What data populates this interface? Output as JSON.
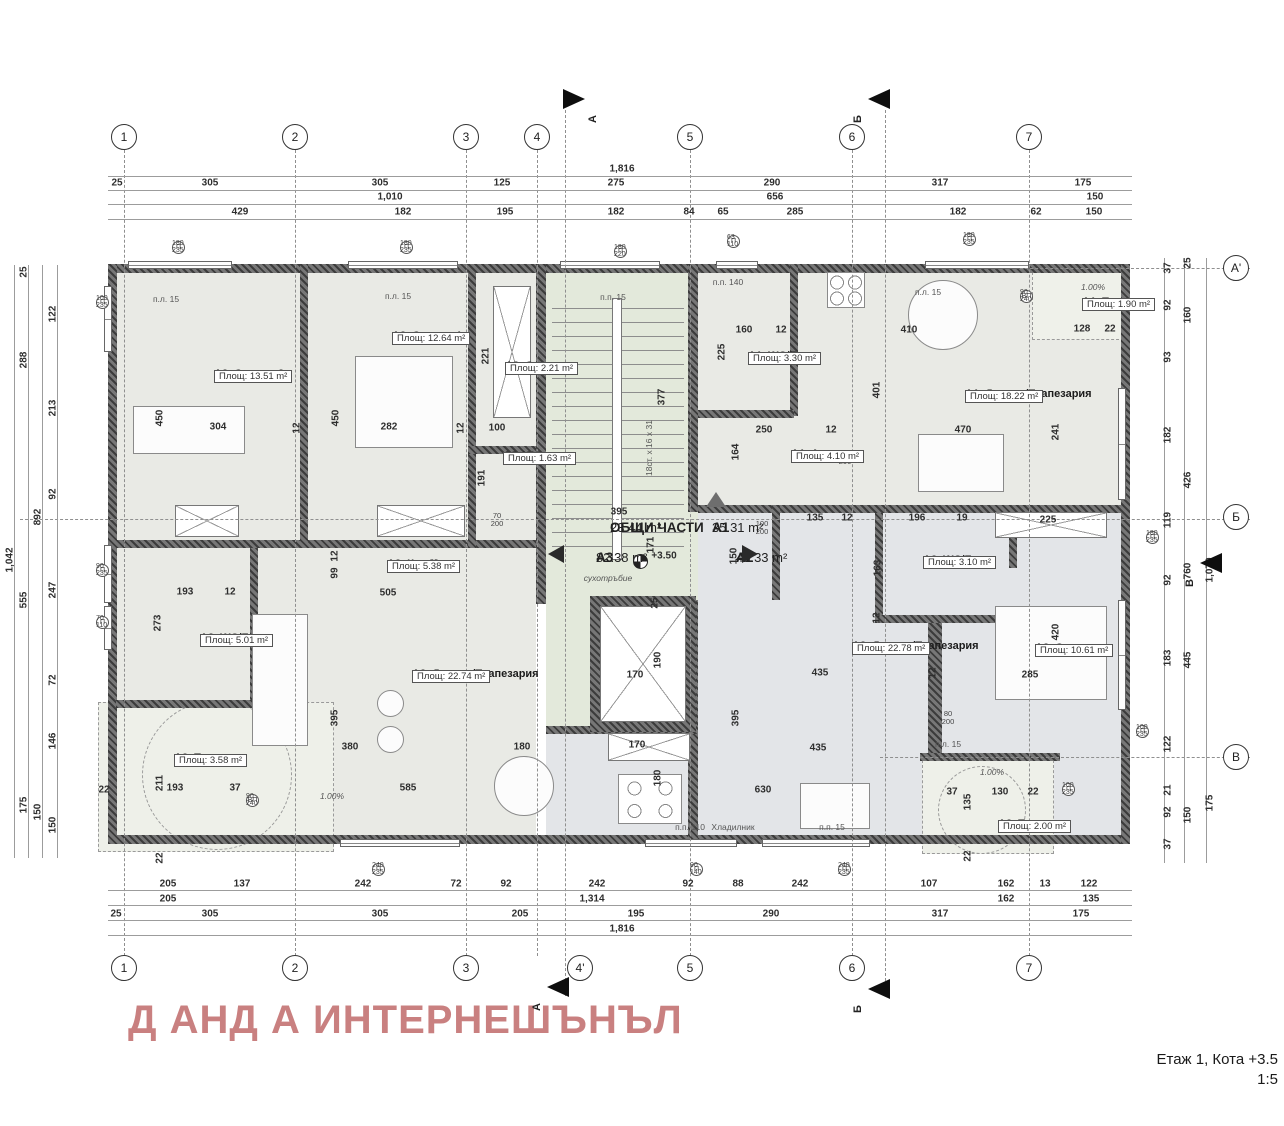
{
  "meta": {
    "watermark": "Д АНД А ИНТЕРНЕШЪНЪЛ",
    "title_line1": "Етаж 1, Кота +3.5",
    "title_line2": "1:5"
  },
  "colors": {
    "watermark": "#c98080",
    "wall": "#4a4a4a",
    "room_fill": "#e9eae5",
    "common_fill": "#e3e9db",
    "a2_fill": "#e3e5e8",
    "terrace_fill": "#eef0e9"
  },
  "grid": {
    "top": [
      {
        "t": "1",
        "x": 124
      },
      {
        "t": "2",
        "x": 295
      },
      {
        "t": "3",
        "x": 466
      },
      {
        "t": "4",
        "x": 537
      },
      {
        "t": "5",
        "x": 690
      },
      {
        "t": "6",
        "x": 852
      },
      {
        "t": "7",
        "x": 1029
      }
    ],
    "bottom": [
      {
        "t": "1",
        "x": 124
      },
      {
        "t": "2",
        "x": 295
      },
      {
        "t": "3",
        "x": 466
      },
      {
        "t": "4'",
        "x": 580
      },
      {
        "t": "5",
        "x": 690
      },
      {
        "t": "6",
        "x": 852
      },
      {
        "t": "7",
        "x": 1029
      }
    ],
    "right": [
      {
        "t": "A'",
        "y": 268
      },
      {
        "t": "Б",
        "y": 517
      },
      {
        "t": "В",
        "y": 757
      }
    ],
    "flags": [
      {
        "t": "А",
        "x": 563,
        "y": 99,
        "d": "right"
      },
      {
        "t": "Б",
        "x": 868,
        "y": 99,
        "d": "left"
      },
      {
        "t": "А",
        "x": 547,
        "y": 987,
        "d": "left"
      },
      {
        "t": "Б",
        "x": 868,
        "y": 989,
        "d": "left"
      },
      {
        "t": "В",
        "x": 1200,
        "y": 563,
        "d": "left"
      }
    ]
  },
  "rooms": [
    {
      "n": "A3_Спалня 2",
      "a": "Площ: 13.51 m²",
      "x": 214,
      "y": 368
    },
    {
      "n": "A3_Спалня 1",
      "a": "Площ: 12.64 m²",
      "x": 392,
      "y": 330
    },
    {
      "n": "A3_Склад",
      "a": "Площ: 2.21 m²",
      "x": 505,
      "y": 360
    },
    {
      "n": "A3_WC",
      "a": "Площ: 1.63 m²",
      "x": 503,
      "y": 450
    },
    {
      "n": "A1_WC/Баня",
      "a": "Площ: 3.30 m²",
      "x": 748,
      "y": 350
    },
    {
      "n": "A1_Антре",
      "a": "Площ: 4.10 m²",
      "x": 791,
      "y": 448
    },
    {
      "n": "A1_Дневна/Трапезария",
      "a": "Площ: 18.22 m²",
      "x": 965,
      "y": 388
    },
    {
      "n": "A1_Тераса",
      "a": "Площ: 1.90 m²",
      "x": 1082,
      "y": 296
    },
    {
      "n": "A3_Коридор",
      "a": "Площ: 5.38 m²",
      "x": 387,
      "y": 558
    },
    {
      "n": "A3_WC/Баня",
      "a": "Площ: 5.01 m²",
      "x": 200,
      "y": 632
    },
    {
      "n": "A3_Дневна/Трапезария",
      "a": "Площ: 22.74 m²",
      "x": 412,
      "y": 668
    },
    {
      "n": "A3_Тераса",
      "a": "Площ: 3.58 m²",
      "x": 174,
      "y": 752
    },
    {
      "n": "A2_WC/Баня",
      "a": "Площ: 3.10 m²",
      "x": 923,
      "y": 554
    },
    {
      "n": "A2_Дневна/Трапезария",
      "a": "Площ: 22.78 m²",
      "x": 852,
      "y": 640
    },
    {
      "n": "A2_Спалня",
      "a": "Площ: 10.61 m²",
      "x": 1035,
      "y": 642
    },
    {
      "n": "A2_Тераса",
      "a": "Площ: 2.00 m²",
      "x": 998,
      "y": 818
    }
  ],
  "summary": [
    {
      "c": "ОБЩИ ЧАСТИ",
      "a": "23.44 m²",
      "x": 610,
      "y": 520
    },
    {
      "c": "А3",
      "a": "82.38 m²",
      "x": 596,
      "y": 550,
      "arrow": "left",
      "ax": 556,
      "ay": 553
    },
    {
      "c": "A1",
      "a": "35.31 m²",
      "x": 712,
      "y": 520,
      "arrow": "up",
      "ax": 714,
      "ay": 500
    },
    {
      "c": "A2",
      "a": "48.33 m²",
      "x": 736,
      "y": 550,
      "arrow": "right",
      "ax": 750,
      "ay": 553
    }
  ],
  "level_mark": {
    "t": "+3.50",
    "x": 664,
    "y": 556
  },
  "dims": {
    "top": [
      {
        "t": "1,816",
        "x": 622,
        "y": 169
      },
      {
        "t": "25",
        "x": 117,
        "y": 183
      },
      {
        "t": "305",
        "x": 210,
        "y": 183
      },
      {
        "t": "305",
        "x": 380,
        "y": 183
      },
      {
        "t": "125",
        "x": 502,
        "y": 183
      },
      {
        "t": "275",
        "x": 616,
        "y": 183
      },
      {
        "t": "290",
        "x": 772,
        "y": 183
      },
      {
        "t": "317",
        "x": 940,
        "y": 183
      },
      {
        "t": "175",
        "x": 1083,
        "y": 183
      },
      {
        "t": "1,010",
        "x": 390,
        "y": 197
      },
      {
        "t": "656",
        "x": 775,
        "y": 197
      },
      {
        "t": "150",
        "x": 1095,
        "y": 197
      },
      {
        "t": "429",
        "x": 240,
        "y": 212
      },
      {
        "t": "182",
        "x": 403,
        "y": 212
      },
      {
        "t": "195",
        "x": 505,
        "y": 212
      },
      {
        "t": "182",
        "x": 616,
        "y": 212
      },
      {
        "t": "84",
        "x": 689,
        "y": 212
      },
      {
        "t": "65",
        "x": 723,
        "y": 212
      },
      {
        "t": "285",
        "x": 795,
        "y": 212
      },
      {
        "t": "182",
        "x": 958,
        "y": 212
      },
      {
        "t": "62",
        "x": 1036,
        "y": 212
      },
      {
        "t": "150",
        "x": 1094,
        "y": 212
      }
    ],
    "bottom": [
      {
        "t": "205",
        "x": 168,
        "y": 884
      },
      {
        "t": "137",
        "x": 242,
        "y": 884
      },
      {
        "t": "242",
        "x": 363,
        "y": 884
      },
      {
        "t": "72",
        "x": 456,
        "y": 884
      },
      {
        "t": "92",
        "x": 506,
        "y": 884
      },
      {
        "t": "242",
        "x": 597,
        "y": 884
      },
      {
        "t": "92",
        "x": 688,
        "y": 884
      },
      {
        "t": "88",
        "x": 738,
        "y": 884
      },
      {
        "t": "242",
        "x": 800,
        "y": 884
      },
      {
        "t": "107",
        "x": 929,
        "y": 884
      },
      {
        "t": "162",
        "x": 1006,
        "y": 884
      },
      {
        "t": "13",
        "x": 1045,
        "y": 884
      },
      {
        "t": "122",
        "x": 1089,
        "y": 884
      },
      {
        "t": "205",
        "x": 168,
        "y": 899
      },
      {
        "t": "1,314",
        "x": 592,
        "y": 899
      },
      {
        "t": "162",
        "x": 1006,
        "y": 899
      },
      {
        "t": "135",
        "x": 1091,
        "y": 899
      },
      {
        "t": "25",
        "x": 116,
        "y": 914
      },
      {
        "t": "305",
        "x": 210,
        "y": 914
      },
      {
        "t": "305",
        "x": 380,
        "y": 914
      },
      {
        "t": "205",
        "x": 520,
        "y": 914
      },
      {
        "t": "195",
        "x": 636,
        "y": 914
      },
      {
        "t": "290",
        "x": 771,
        "y": 914
      },
      {
        "t": "317",
        "x": 940,
        "y": 914
      },
      {
        "t": "175",
        "x": 1081,
        "y": 914
      },
      {
        "t": "1,816",
        "x": 622,
        "y": 929
      }
    ],
    "left": [
      {
        "t": "1,042",
        "x": 10,
        "y": 560,
        "r": -90
      },
      {
        "t": "25",
        "x": 24,
        "y": 272,
        "r": -90
      },
      {
        "t": "288",
        "x": 24,
        "y": 360,
        "r": -90
      },
      {
        "t": "555",
        "x": 24,
        "y": 600,
        "r": -90
      },
      {
        "t": "175",
        "x": 24,
        "y": 805,
        "r": -90
      },
      {
        "t": "892",
        "x": 38,
        "y": 517,
        "r": -90
      },
      {
        "t": "150",
        "x": 38,
        "y": 812,
        "r": -90
      },
      {
        "t": "122",
        "x": 53,
        "y": 314,
        "r": -90
      },
      {
        "t": "213",
        "x": 53,
        "y": 408,
        "r": -90
      },
      {
        "t": "92",
        "x": 53,
        "y": 494,
        "r": -90
      },
      {
        "t": "247",
        "x": 53,
        "y": 590,
        "r": -90
      },
      {
        "t": "72",
        "x": 53,
        "y": 680,
        "r": -90
      },
      {
        "t": "146",
        "x": 53,
        "y": 741,
        "r": -90
      },
      {
        "t": "150",
        "x": 53,
        "y": 825,
        "r": -90
      }
    ],
    "right": [
      {
        "t": "37",
        "x": 1168,
        "y": 268,
        "r": -90
      },
      {
        "t": "92",
        "x": 1168,
        "y": 305,
        "r": -90
      },
      {
        "t": "93",
        "x": 1168,
        "y": 357,
        "r": -90
      },
      {
        "t": "182",
        "x": 1168,
        "y": 435,
        "r": -90
      },
      {
        "t": "119",
        "x": 1168,
        "y": 520,
        "r": -90
      },
      {
        "t": "92",
        "x": 1168,
        "y": 580,
        "r": -90
      },
      {
        "t": "183",
        "x": 1168,
        "y": 658,
        "r": -90
      },
      {
        "t": "122",
        "x": 1168,
        "y": 744,
        "r": -90
      },
      {
        "t": "21",
        "x": 1168,
        "y": 790,
        "r": -90
      },
      {
        "t": "92",
        "x": 1168,
        "y": 812,
        "r": -90
      },
      {
        "t": "37",
        "x": 1168,
        "y": 844,
        "r": -90
      },
      {
        "t": "25",
        "x": 1188,
        "y": 263,
        "r": -90
      },
      {
        "t": "160",
        "x": 1188,
        "y": 315,
        "r": -90
      },
      {
        "t": "426",
        "x": 1188,
        "y": 480,
        "r": -90
      },
      {
        "t": "760",
        "x": 1188,
        "y": 571,
        "r": -90
      },
      {
        "t": "445",
        "x": 1188,
        "y": 660,
        "r": -90
      },
      {
        "t": "150",
        "x": 1188,
        "y": 815,
        "r": -90
      },
      {
        "t": "1,070",
        "x": 1210,
        "y": 570,
        "r": -90
      },
      {
        "t": "175",
        "x": 1210,
        "y": 803,
        "r": -90
      }
    ],
    "plan": [
      {
        "t": "450",
        "x": 160,
        "y": 418,
        "r": -90
      },
      {
        "t": "304",
        "x": 218,
        "y": 427
      },
      {
        "t": "12",
        "x": 297,
        "y": 428,
        "r": -90
      },
      {
        "t": "450",
        "x": 336,
        "y": 418,
        "r": -90
      },
      {
        "t": "282",
        "x": 389,
        "y": 427
      },
      {
        "t": "12",
        "x": 461,
        "y": 428,
        "r": -90
      },
      {
        "t": "100",
        "x": 497,
        "y": 428
      },
      {
        "t": "221",
        "x": 486,
        "y": 356,
        "r": -90
      },
      {
        "t": "191",
        "x": 482,
        "y": 478,
        "r": -90
      },
      {
        "t": "160",
        "x": 744,
        "y": 330
      },
      {
        "t": "12",
        "x": 781,
        "y": 330
      },
      {
        "t": "225",
        "x": 722,
        "y": 352,
        "r": -90
      },
      {
        "t": "250",
        "x": 764,
        "y": 430
      },
      {
        "t": "12",
        "x": 831,
        "y": 430
      },
      {
        "t": "164",
        "x": 736,
        "y": 452,
        "r": -90
      },
      {
        "t": "410",
        "x": 909,
        "y": 330
      },
      {
        "t": "401",
        "x": 877,
        "y": 390,
        "r": -90
      },
      {
        "t": "470",
        "x": 963,
        "y": 430
      },
      {
        "t": "241",
        "x": 1056,
        "y": 432,
        "r": -90
      },
      {
        "t": "128",
        "x": 1082,
        "y": 329
      },
      {
        "t": "22",
        "x": 1110,
        "y": 329
      },
      {
        "t": "395",
        "x": 619,
        "y": 512
      },
      {
        "t": "171",
        "x": 651,
        "y": 545,
        "r": -90
      },
      {
        "t": "150",
        "x": 734,
        "y": 556,
        "r": -90
      },
      {
        "t": "25",
        "x": 655,
        "y": 603,
        "r": -90
      },
      {
        "t": "170",
        "x": 635,
        "y": 675
      },
      {
        "t": "190",
        "x": 658,
        "y": 660,
        "r": -90
      },
      {
        "t": "170",
        "x": 637,
        "y": 745
      },
      {
        "t": "180",
        "x": 658,
        "y": 778,
        "r": -90
      },
      {
        "t": "377",
        "x": 662,
        "y": 397,
        "r": -90
      },
      {
        "t": "630",
        "x": 763,
        "y": 790
      },
      {
        "t": "395",
        "x": 736,
        "y": 718,
        "r": -90
      },
      {
        "t": "435",
        "x": 820,
        "y": 673
      },
      {
        "t": "435",
        "x": 818,
        "y": 748
      },
      {
        "t": "135",
        "x": 815,
        "y": 518
      },
      {
        "t": "12",
        "x": 847,
        "y": 518
      },
      {
        "t": "196",
        "x": 917,
        "y": 518
      },
      {
        "t": "19",
        "x": 962,
        "y": 518
      },
      {
        "t": "225",
        "x": 1048,
        "y": 520
      },
      {
        "t": "163",
        "x": 878,
        "y": 568,
        "r": -90
      },
      {
        "t": "12",
        "x": 877,
        "y": 618,
        "r": -90
      },
      {
        "t": "420",
        "x": 1056,
        "y": 632,
        "r": -90
      },
      {
        "t": "285",
        "x": 1030,
        "y": 675
      },
      {
        "t": "12",
        "x": 933,
        "y": 673,
        "r": -90
      },
      {
        "t": "505",
        "x": 388,
        "y": 593
      },
      {
        "t": "99",
        "x": 335,
        "y": 573,
        "r": -90
      },
      {
        "t": "12",
        "x": 335,
        "y": 556,
        "r": -90
      },
      {
        "t": "193",
        "x": 185,
        "y": 592
      },
      {
        "t": "12",
        "x": 230,
        "y": 592
      },
      {
        "t": "273",
        "x": 158,
        "y": 623,
        "r": -90
      },
      {
        "t": "395",
        "x": 335,
        "y": 718,
        "r": -90
      },
      {
        "t": "380",
        "x": 350,
        "y": 747
      },
      {
        "t": "585",
        "x": 408,
        "y": 788
      },
      {
        "t": "180",
        "x": 522,
        "y": 747
      },
      {
        "t": "211",
        "x": 160,
        "y": 783,
        "r": -90
      },
      {
        "t": "193",
        "x": 175,
        "y": 788
      },
      {
        "t": "37",
        "x": 235,
        "y": 788
      },
      {
        "t": "22",
        "x": 104,
        "y": 790
      },
      {
        "t": "22",
        "x": 160,
        "y": 858,
        "r": -90
      },
      {
        "t": "37",
        "x": 952,
        "y": 792
      },
      {
        "t": "130",
        "x": 1000,
        "y": 792
      },
      {
        "t": "22",
        "x": 1033,
        "y": 792
      },
      {
        "t": "135",
        "x": 968,
        "y": 802,
        "r": -90
      },
      {
        "t": "22",
        "x": 968,
        "y": 856,
        "r": -90
      }
    ]
  },
  "markers": [
    {
      "s": "П",
      "v": "180|235",
      "x": 172,
      "y": 247
    },
    {
      "s": "П",
      "v": "180|235",
      "x": 400,
      "y": 247
    },
    {
      "s": "П",
      "v": "180|220",
      "x": 614,
      "y": 251
    },
    {
      "s": "П",
      "v": "63|110",
      "x": 727,
      "y": 241
    },
    {
      "s": "П",
      "v": "180|235",
      "x": 963,
      "y": 239
    },
    {
      "s": "ВП",
      "v": "90|240",
      "x": 1020,
      "y": 296
    },
    {
      "s": "П",
      "v": "180|235",
      "x": 1146,
      "y": 537
    },
    {
      "s": "П",
      "v": "100|235",
      "x": 1136,
      "y": 731
    },
    {
      "s": "П",
      "v": "100|235",
      "x": 96,
      "y": 302
    },
    {
      "s": "П",
      "v": "90|235",
      "x": 96,
      "y": 570
    },
    {
      "s": "П",
      "v": "70|110",
      "x": 96,
      "y": 622
    },
    {
      "s": "П",
      "v": "240|235",
      "x": 372,
      "y": 869
    },
    {
      "s": "П",
      "v": "90|140",
      "x": 690,
      "y": 869
    },
    {
      "s": "П",
      "v": "240|235",
      "x": 838,
      "y": 869
    },
    {
      "s": "П",
      "v": "100|235",
      "x": 1062,
      "y": 789
    },
    {
      "s": "ВП",
      "v": "90|240",
      "x": 246,
      "y": 800
    }
  ],
  "doors": [
    {
      "t": "70|200",
      "x": 497,
      "y": 520
    },
    {
      "t": "90|200",
      "x": 845,
      "y": 458
    },
    {
      "t": "80|200",
      "x": 948,
      "y": 718
    },
    {
      "t": "100|200",
      "x": 762,
      "y": 528
    },
    {
      "t": "90|200",
      "x": 434,
      "y": 566
    }
  ],
  "notes": [
    {
      "t": "сухотръбие",
      "x": 608,
      "y": 578,
      "i": 1
    },
    {
      "t": "18ст. x 16 x 31",
      "x": 649,
      "y": 448,
      "r": -90
    },
    {
      "t": "1.00%",
      "x": 1093,
      "y": 287,
      "i": 1
    },
    {
      "t": "1.00%",
      "x": 332,
      "y": 796,
      "i": 1
    },
    {
      "t": "1.00%",
      "x": 992,
      "y": 772,
      "i": 1
    },
    {
      "t": "п.л. 15",
      "x": 166,
      "y": 299
    },
    {
      "t": "п.л. 15",
      "x": 398,
      "y": 296
    },
    {
      "t": "п.л. 15",
      "x": 928,
      "y": 292
    },
    {
      "t": "п.п. 15",
      "x": 613,
      "y": 297
    },
    {
      "t": "п.п. 15",
      "x": 832,
      "y": 827
    },
    {
      "t": "п.л. 15",
      "x": 948,
      "y": 744
    },
    {
      "t": "п.п. 140",
      "x": 728,
      "y": 282
    },
    {
      "t": "п.п. 110",
      "x": 690,
      "y": 827
    },
    {
      "t": "Хладилник",
      "x": 733,
      "y": 827
    }
  ]
}
